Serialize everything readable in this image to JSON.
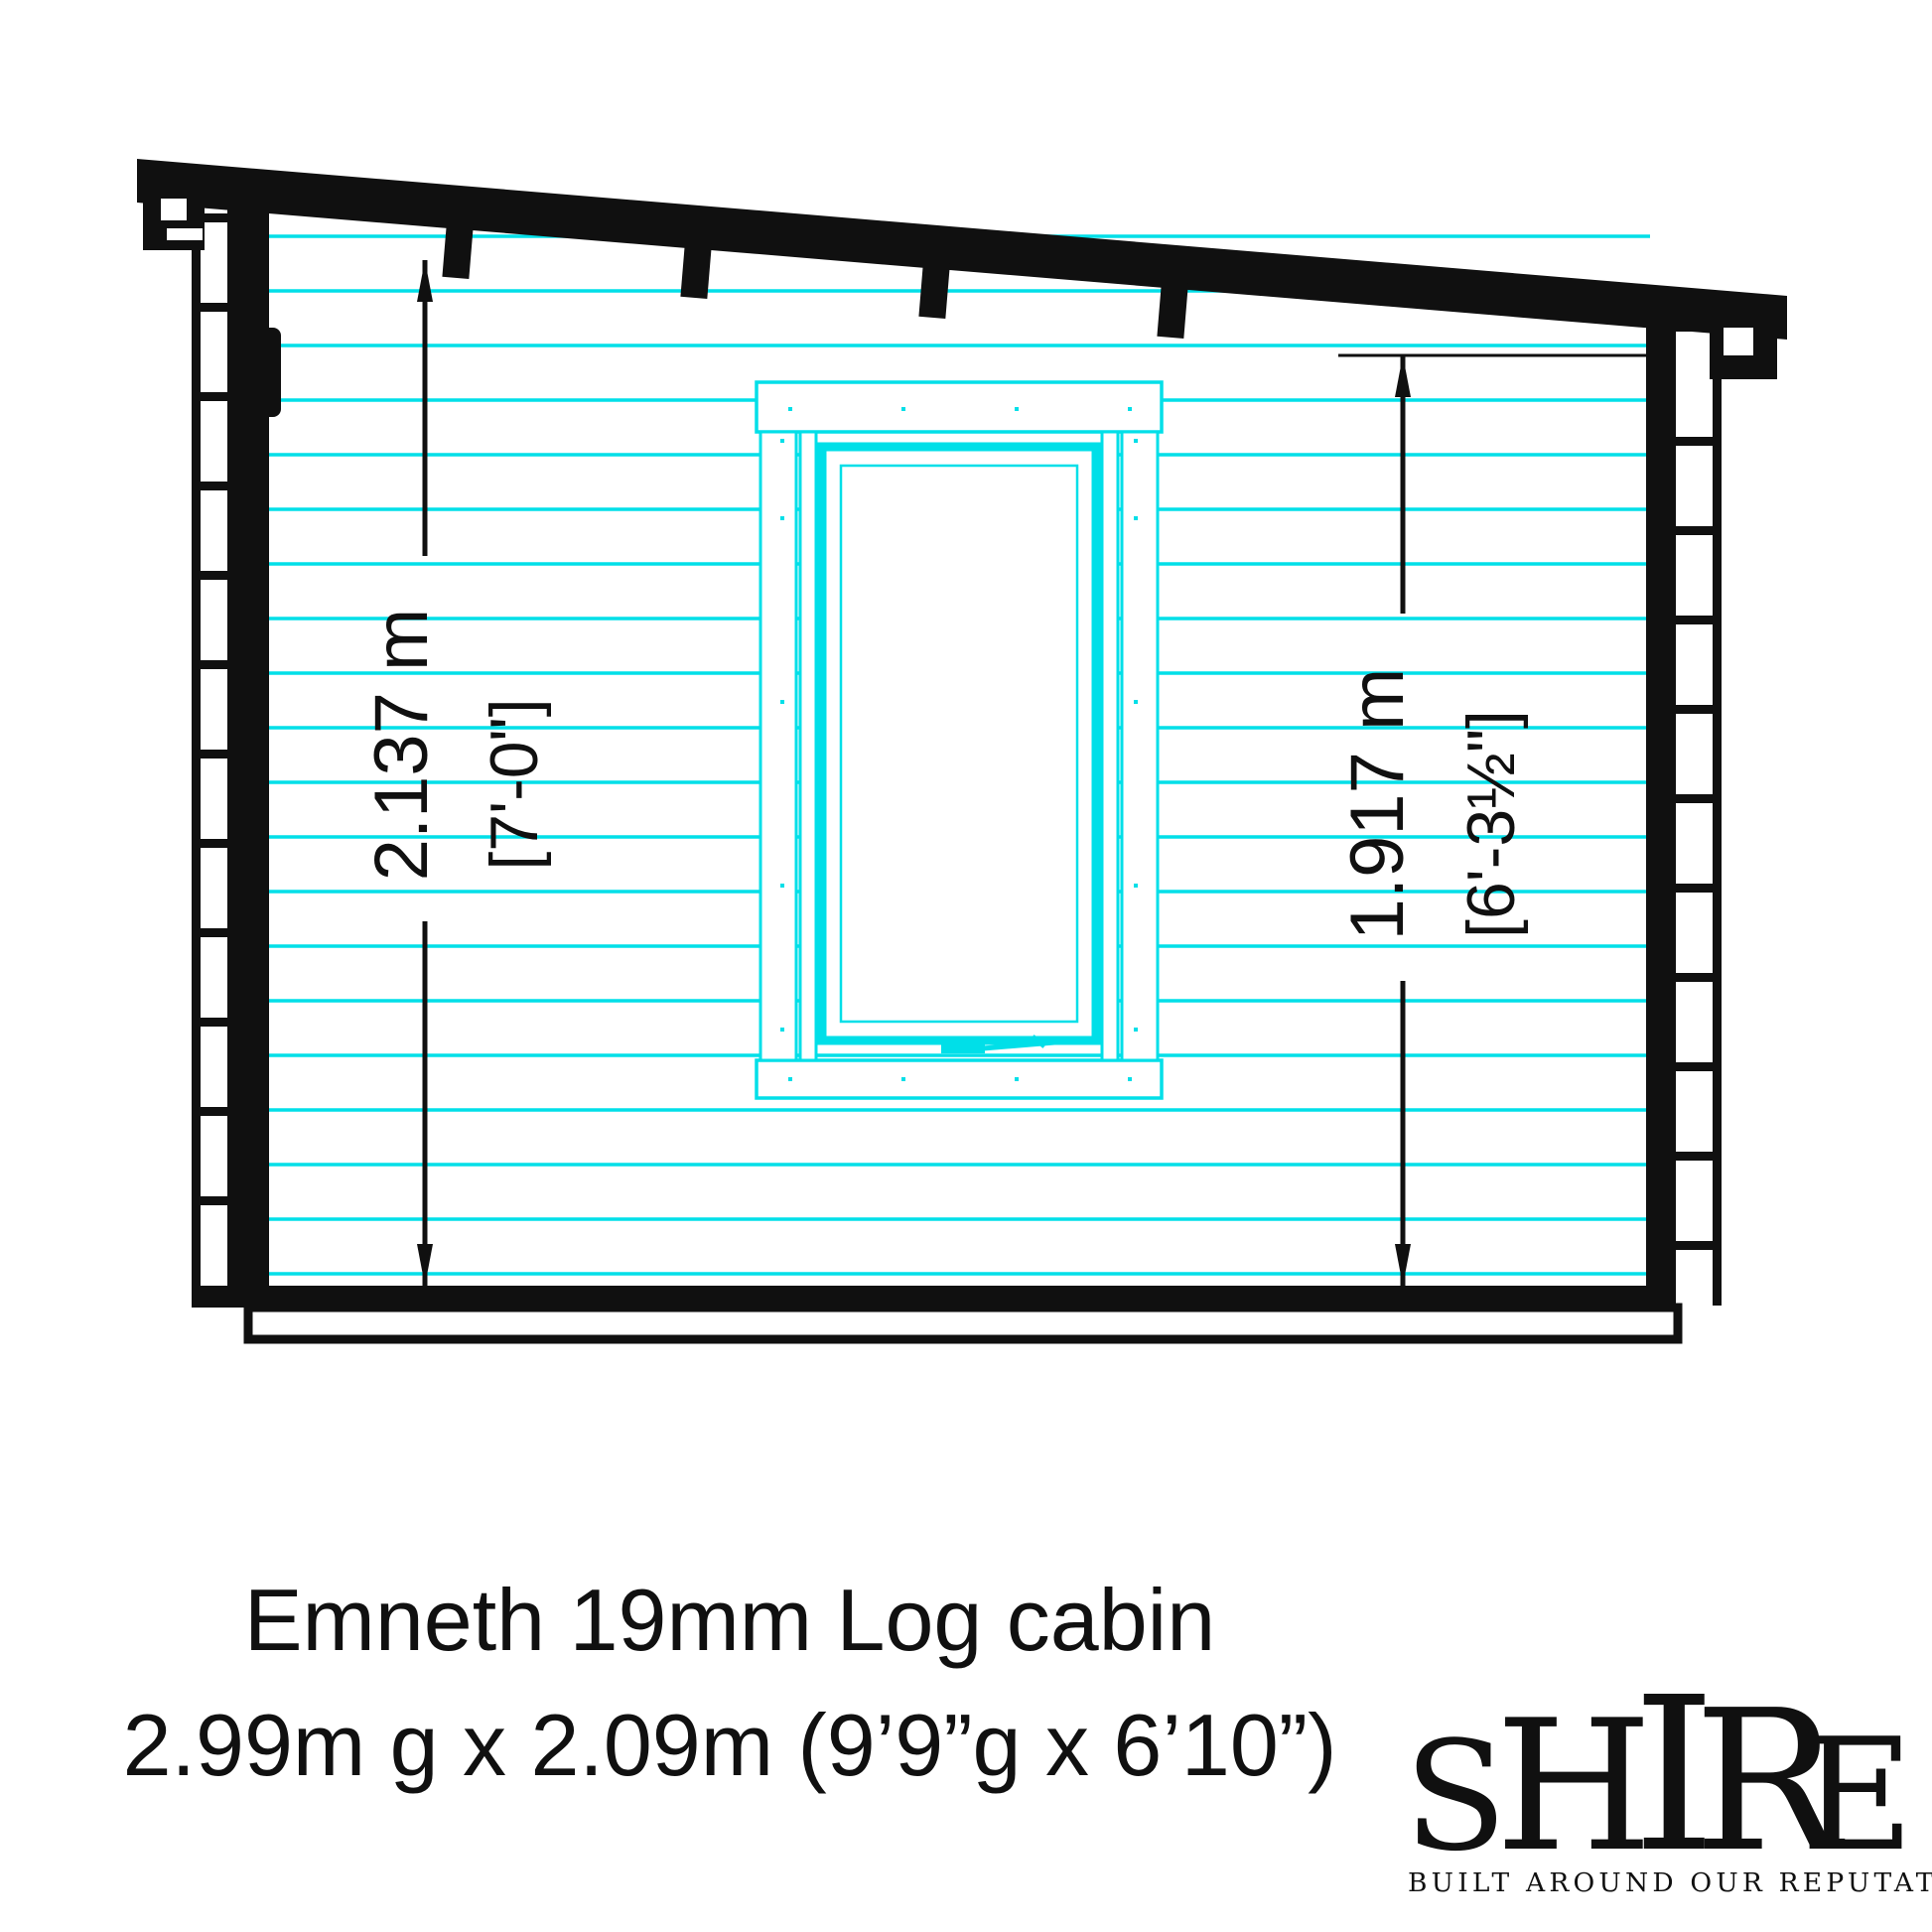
{
  "drawing": {
    "kind": "log-cabin-side-elevation",
    "accent_color": "#00dfe8",
    "line_color": "#101010",
    "background": "#ffffff"
  },
  "dimensions": {
    "left": {
      "metric": "2.137 m",
      "imperial": "[7'-0\"]"
    },
    "right": {
      "metric": "1.917 m",
      "imperial": "[6'-3½\"]"
    }
  },
  "caption": {
    "line1": "Emneth 19mm Log cabin",
    "line2": "2.99m g x 2.09m (9’9”g x 6’10”)"
  },
  "logo": {
    "letters": [
      "S",
      "H",
      "I",
      "R",
      "E"
    ],
    "tagline": "BUILT AROUND OUR REPUTATION",
    "flag_red": "#cf2233",
    "flag_blue": "#1d3c8f",
    "flag_white": "#e8eef5"
  }
}
